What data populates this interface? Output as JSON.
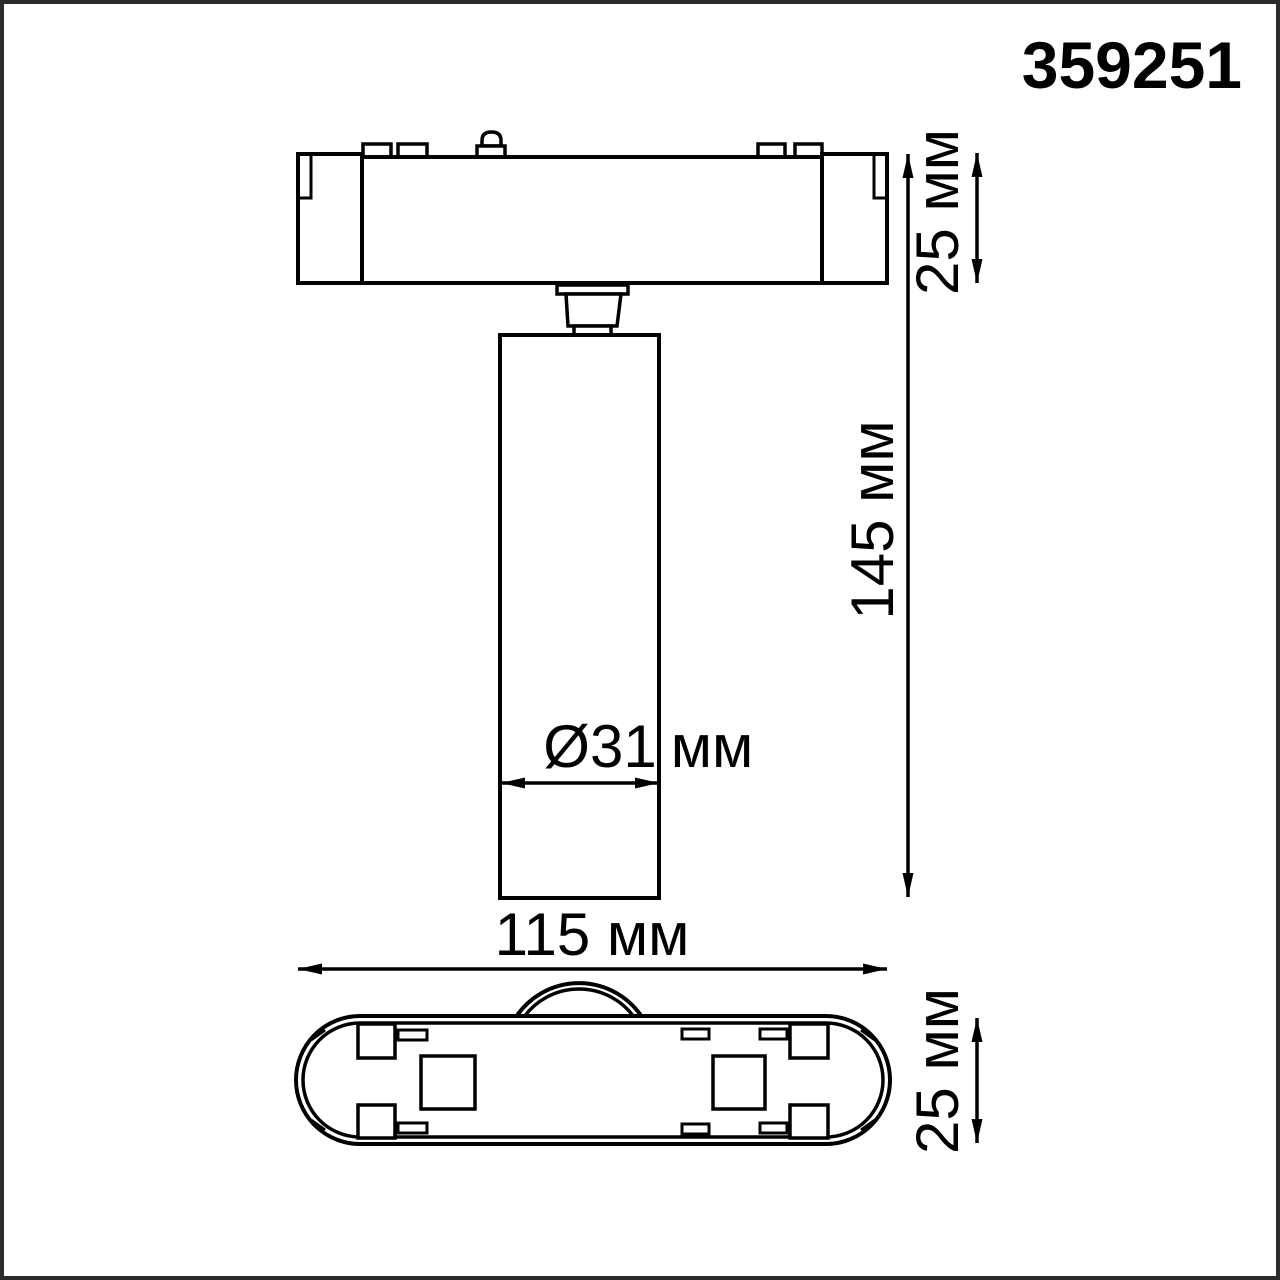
{
  "product_code": "359251",
  "labels": {
    "base_height": "25 мм",
    "overall_height": "145 мм",
    "diameter_value": "Ø31",
    "diameter_unit": "мм",
    "overall_width": "115 мм",
    "base_depth": "25 мм"
  },
  "colors": {
    "line": "#000000",
    "background": "#ffffff",
    "frame": "#2b2b2b"
  }
}
